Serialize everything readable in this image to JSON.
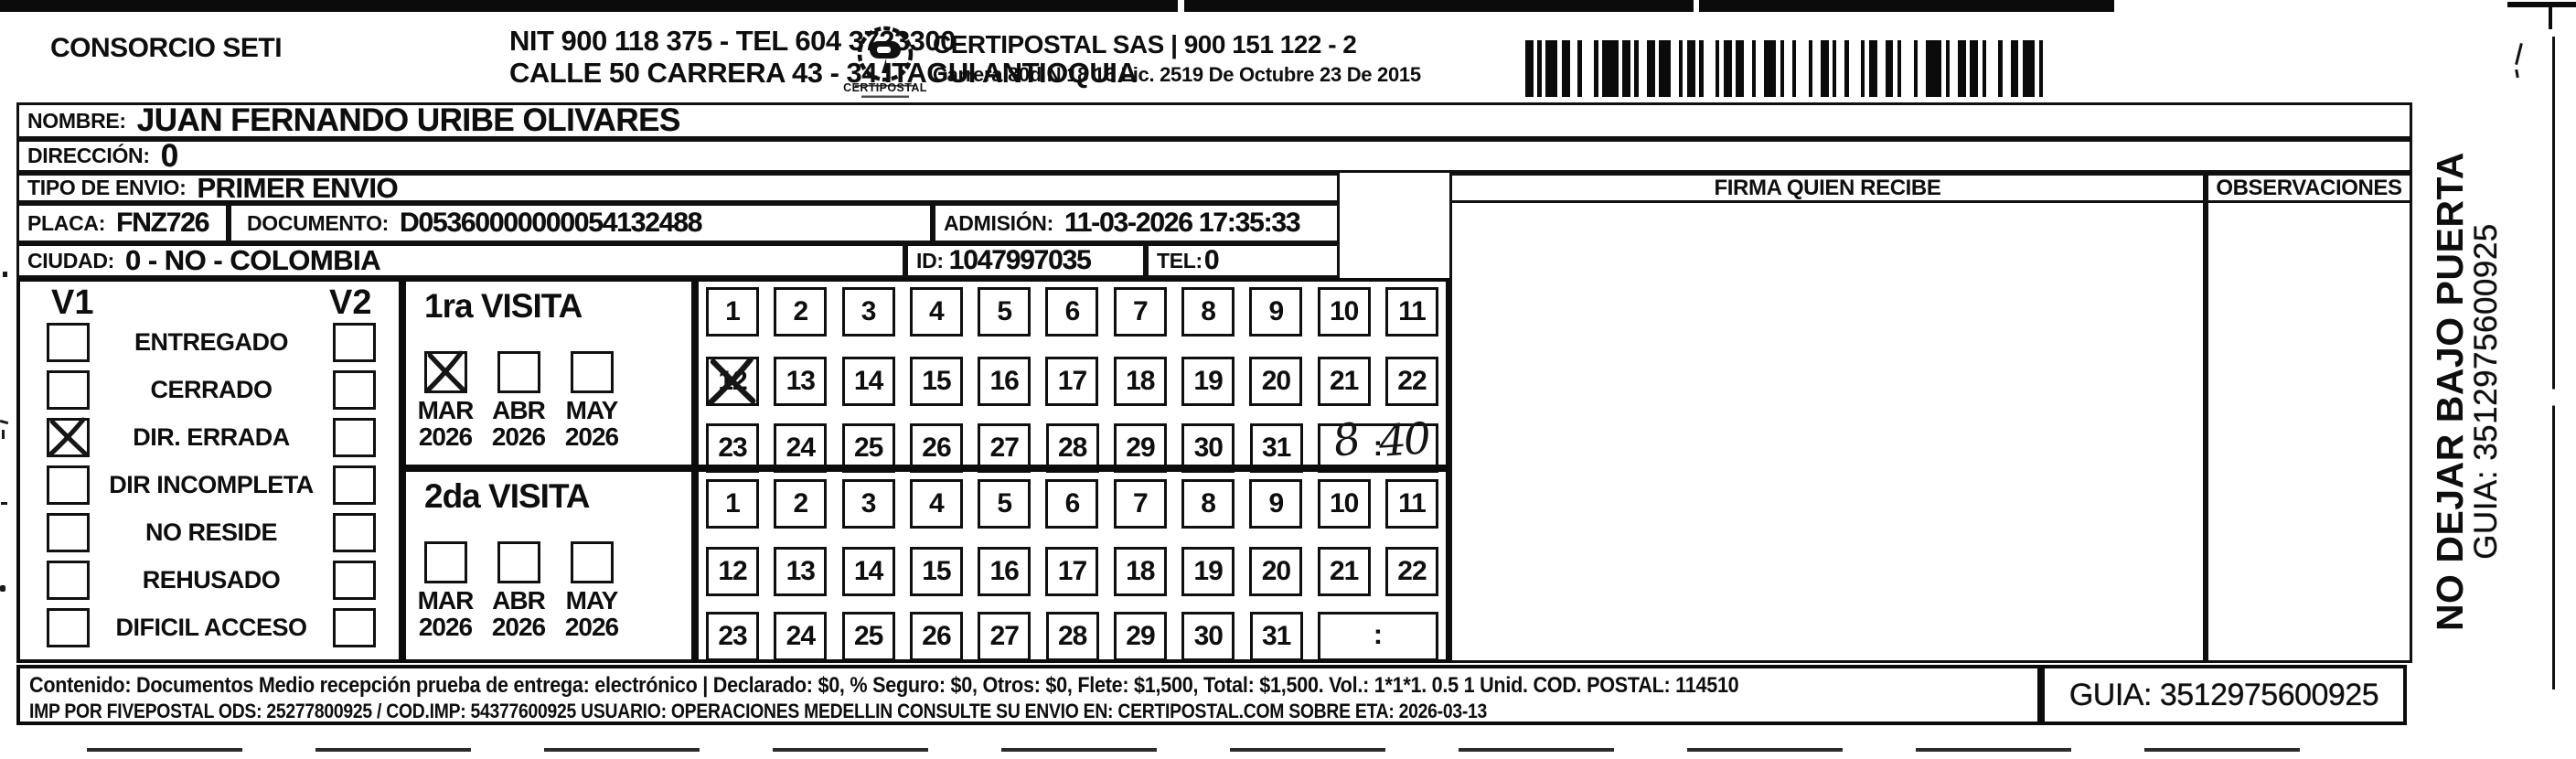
{
  "header": {
    "company": "CONSORCIO SETI",
    "nit_line": "NIT 900 118 375 - TEL 604 3723300",
    "address_line": "CALLE 50 CARRERA 43 - 34 ITAGUI ANTIOQUIA",
    "logo_caption": "CERTIPOSTAL",
    "right_company": "CERTIPOSTAL SAS | 900 151 122 - 2",
    "right_address": "Carrera 80d N 18 16  Lic. 2519 De Octubre 23 De 2015",
    "icons": {
      "logo": "certipostal-stamp-logo",
      "barcode": "shipment-barcode"
    }
  },
  "recipient": {
    "nombre_label": "NOMBRE:",
    "nombre": "JUAN FERNANDO URIBE OLIVARES",
    "direccion_label": "DIRECCIÓN:",
    "direccion": "0",
    "tipo_envio_label": "TIPO DE ENVIO:",
    "tipo_envio": "PRIMER ENVIO",
    "placa_label": "PLACA:",
    "placa": "FNZ726",
    "documento_label": "DOCUMENTO:",
    "documento": "D05360000000054132488",
    "admision_label": "ADMISIÓN:",
    "admision": "11-03-2026 17:35:33",
    "ciudad_label": "CIUDAD:",
    "ciudad": "0 - NO - COLOMBIA",
    "id_label": "ID:",
    "id_value": "1047997035",
    "tel_label": "TEL:",
    "tel": "0"
  },
  "firma": {
    "header": "FIRMA QUIEN RECIBE"
  },
  "observaciones": {
    "header": "OBSERVACIONES"
  },
  "status": {
    "v1_label": "V1",
    "v2_label": "V2",
    "items": [
      {
        "label": "ENTREGADO",
        "v1_checked": false,
        "v2_checked": false
      },
      {
        "label": "CERRADO",
        "v1_checked": false,
        "v2_checked": false
      },
      {
        "label": "DIR. ERRADA",
        "v1_checked": true,
        "v2_checked": false
      },
      {
        "label": "DIR INCOMPLETA",
        "v1_checked": false,
        "v2_checked": false
      },
      {
        "label": "NO RESIDE",
        "v1_checked": false,
        "v2_checked": false
      },
      {
        "label": "REHUSADO",
        "v1_checked": false,
        "v2_checked": false
      },
      {
        "label": "DIFICIL ACCESO",
        "v1_checked": false,
        "v2_checked": false
      }
    ]
  },
  "visits": [
    {
      "title": "1ra VISITA",
      "months": [
        {
          "name": "MAR",
          "year": "2026",
          "checked": true
        },
        {
          "name": "ABR",
          "year": "2026",
          "checked": false
        },
        {
          "name": "MAY",
          "year": "2026",
          "checked": false
        }
      ],
      "day_rows": [
        [
          1,
          2,
          3,
          4,
          5,
          6,
          7,
          8,
          9,
          10,
          11
        ],
        [
          12,
          13,
          14,
          15,
          16,
          17,
          18,
          19,
          20,
          21,
          22
        ],
        [
          23,
          24,
          25,
          26,
          27,
          28,
          29,
          30,
          31
        ]
      ],
      "crossed_days": [
        12
      ],
      "time": {
        "hour": "8",
        "colon": ":",
        "minute": "40"
      }
    },
    {
      "title": "2da VISITA",
      "months": [
        {
          "name": "MAR",
          "year": "2026",
          "checked": false
        },
        {
          "name": "ABR",
          "year": "2026",
          "checked": false
        },
        {
          "name": "MAY",
          "year": "2026",
          "checked": false
        }
      ],
      "day_rows": [
        [
          1,
          2,
          3,
          4,
          5,
          6,
          7,
          8,
          9,
          10,
          11
        ],
        [
          12,
          13,
          14,
          15,
          16,
          17,
          18,
          19,
          20,
          21,
          22
        ],
        [
          23,
          24,
          25,
          26,
          27,
          28,
          29,
          30,
          31
        ]
      ],
      "crossed_days": [],
      "time": {
        "hour": "",
        "colon": ":",
        "minute": ""
      }
    }
  ],
  "side_note": {
    "warning": "NO DEJAR BAJO PUERTA",
    "guia": "GUIA: 3512975600925"
  },
  "footer": {
    "line1": "Contenido: Documentos Medio recepción prueba de entrega: electrónico | Declarado: $0, % Seguro: $0, Otros: $0, Flete: $1,500, Total: $1,500. Vol.: 1*1*1. 0.5 1 Unid. COD. POSTAL: 114510",
    "line2": "IMP POR FIVEPOSTAL ODS: 25277800925 / COD.IMP: 54377600925 USUARIO: OPERACIONES MEDELLIN CONSULTE SU ENVIO EN: CERTIPOSTAL.COM SOBRE ETA: 2026-03-13",
    "guia": "GUIA: 3512975600925"
  }
}
